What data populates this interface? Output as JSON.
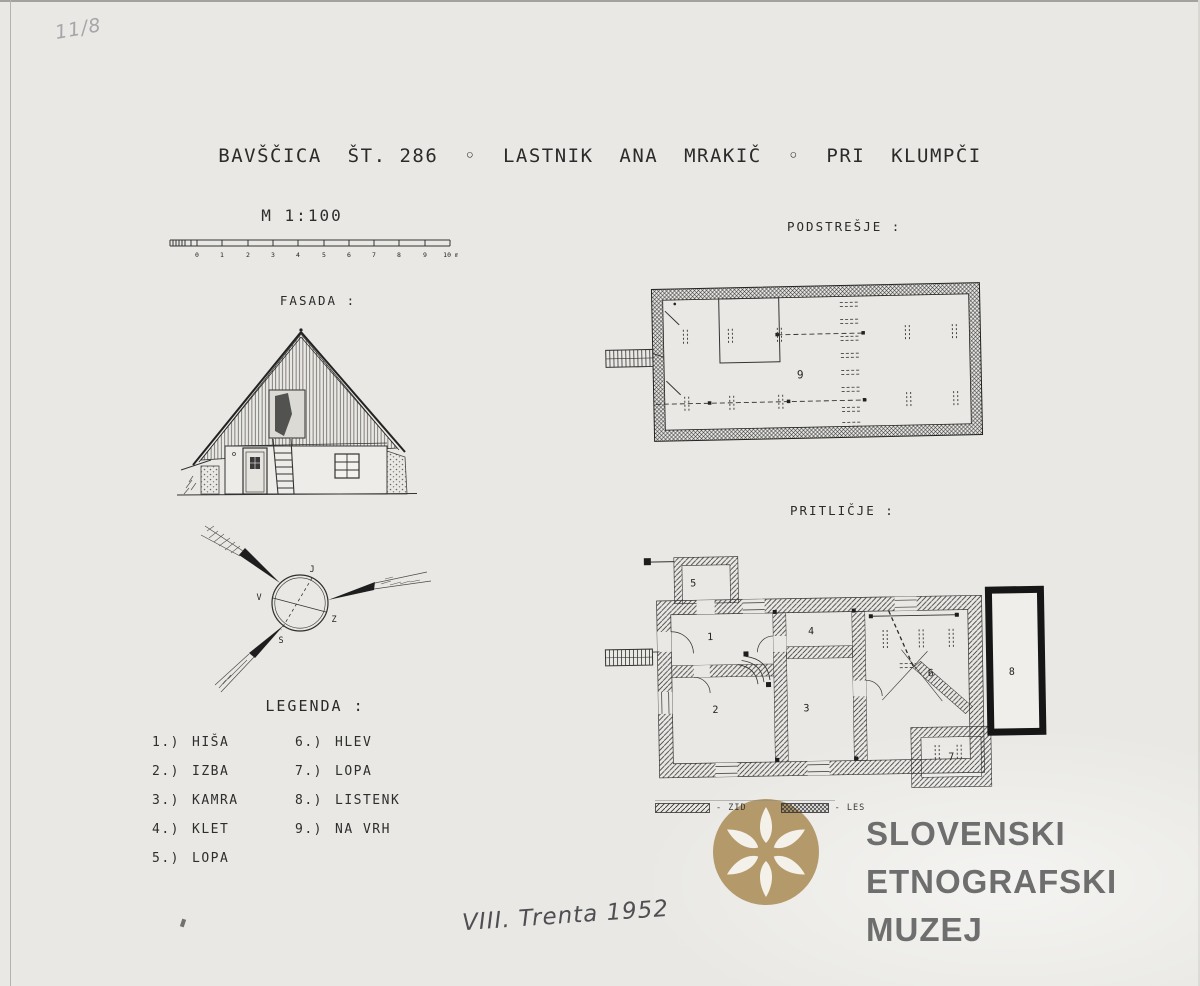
{
  "colors": {
    "paper": "#e9e8e4",
    "ink": "#2e2e2e",
    "pencil": "#a6a6aa",
    "logo_gold": "#b49a6a",
    "logo_text": "#6e6e6e"
  },
  "annotations": {
    "archive_number": "11/8",
    "field_note": "VIII. Trenta 1952"
  },
  "title": {
    "text": "BAVŠČICA  ŠT. 286  ◦  LASTNIK  ANA  MRAKIČ  ◦  PRI  KLUMPČI"
  },
  "scale": {
    "label": "M 1:100",
    "tick_labels": [
      "0",
      "1",
      "2",
      "3",
      "4",
      "5",
      "6",
      "7",
      "8",
      "9",
      "10 m"
    ]
  },
  "sections": {
    "fasada": "FASADA :",
    "podstresje": "PODSTREŠJE :",
    "pritlicje": "PRITLIČJE :",
    "legenda": "LEGENDA :"
  },
  "legend": {
    "column1": [
      {
        "num": "1.)",
        "label": "HIŠA"
      },
      {
        "num": "2.)",
        "label": "IZBA"
      },
      {
        "num": "3.)",
        "label": "KAMRA"
      },
      {
        "num": "4.)",
        "label": "KLET"
      },
      {
        "num": "5.)",
        "label": "LOPA"
      }
    ],
    "column2": [
      {
        "num": "6.)",
        "label": "HLEV"
      },
      {
        "num": "7.)",
        "label": "LOPA"
      },
      {
        "num": "8.)",
        "label": "LISTENK"
      },
      {
        "num": "9.)",
        "label": "NA VRH"
      }
    ]
  },
  "compass": {
    "top": "J",
    "left": "V",
    "right": "Z",
    "bottom": "S"
  },
  "plans": {
    "attic_room": "9",
    "ground_rooms": [
      "1",
      "2",
      "3",
      "4",
      "5",
      "6",
      "7",
      "8"
    ]
  },
  "materials": {
    "zid_label": "- ZID",
    "les_label": "- LES"
  },
  "museum": {
    "line1": "SLOVENSKI",
    "line2": "ETNOGRAFSKI",
    "line3": "MUZEJ"
  }
}
